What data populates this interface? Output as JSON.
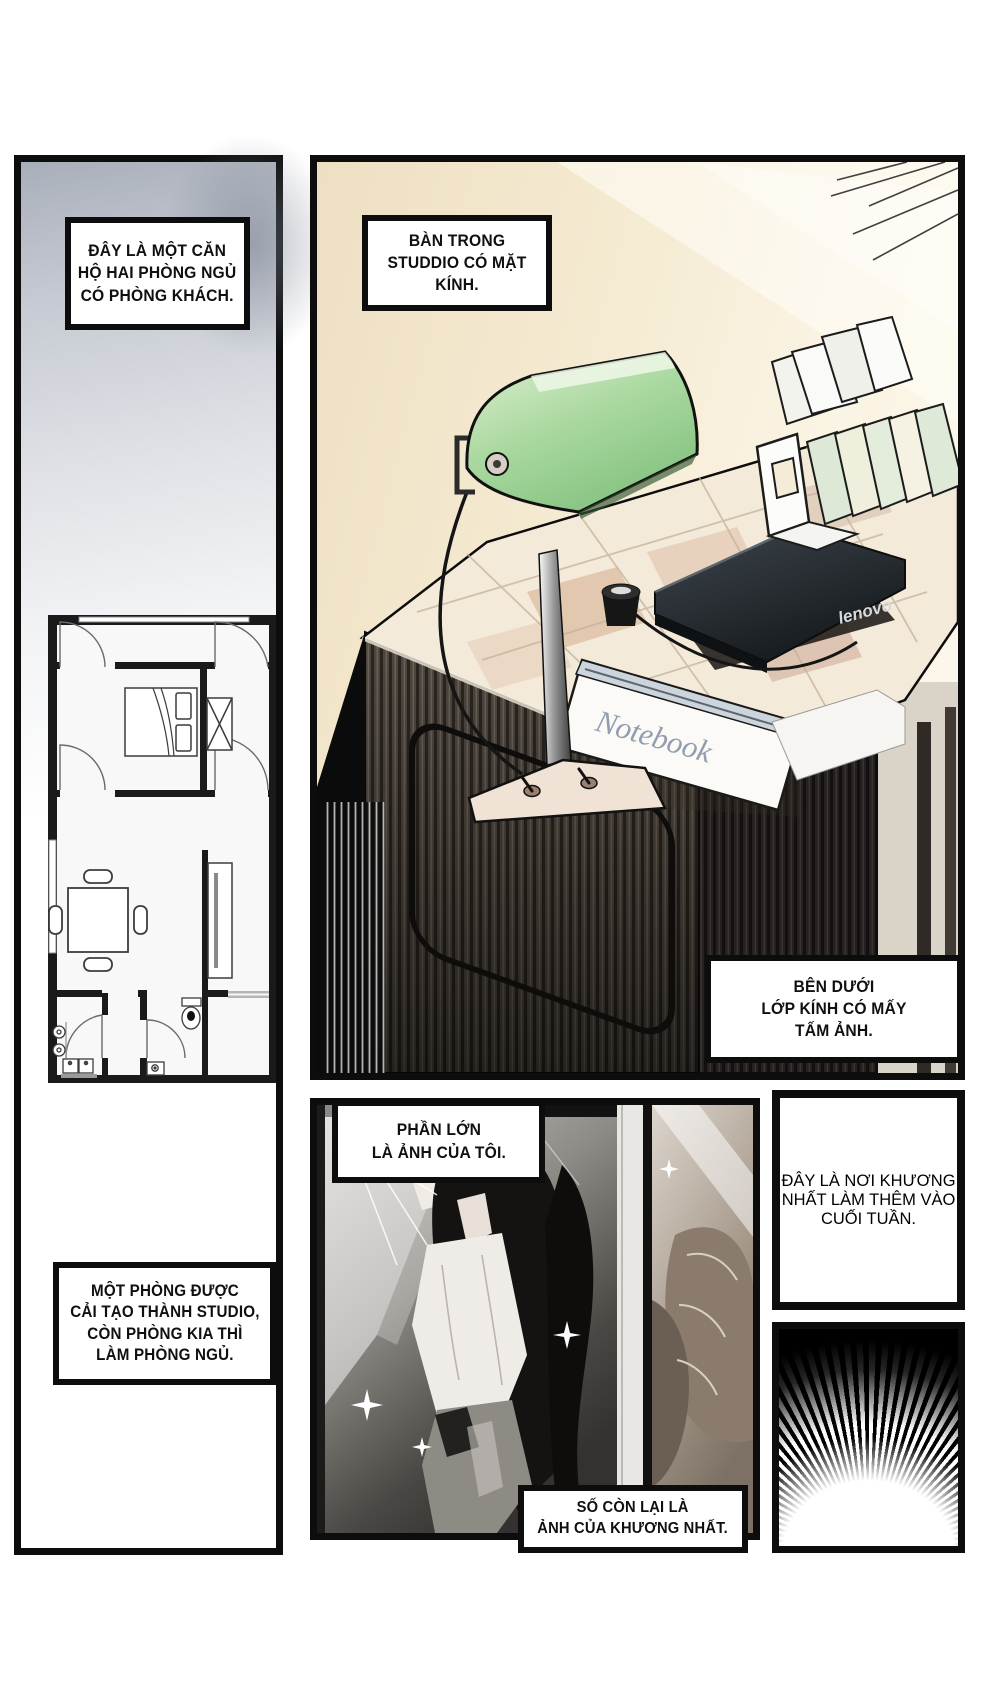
{
  "page": {
    "kind": "comic-page",
    "language": "vi"
  },
  "panels": {
    "apartment": {
      "caption_top": "ĐÂY LÀ MỘT CĂN\nHỘ HAI PHÒNG NGỦ\nCÓ PHÒNG KHÁCH.",
      "caption_bottom": "MỘT PHÒNG ĐƯỢC\nCẢI TẠO THÀNH STUDIO,\nCÒN PHÒNG KIA THÌ\nLÀM PHÒNG NGỦ."
    },
    "studio_desk": {
      "caption_top": "BÀN TRONG\nSTUDDIO CÓ MẶT KÍNH.",
      "caption_bottom": "BÊN DƯỚI\nLỚP KÍNH CÓ MẤY\nTẤM ẢNH.",
      "laptop_logo": "lenovo",
      "notebook_label": "Notebook"
    },
    "photos": {
      "caption_top": "PHẦN LỚN\nLÀ ẢNH CỦA TÔI.",
      "caption_bottom": "SỐ CÒN LẠI LÀ\nẢNH CỦA KHƯƠNG NHẤT."
    },
    "workplace": {
      "caption": "ĐÂY LÀ NƠI KHƯƠNG\nNHẤT LÀM THÊM VÀO\nCUỐI TUẦN."
    }
  },
  "colors": {
    "panel_border": "#0d0d0d",
    "caption_bg": "#ffffff",
    "desk_background": "#f5ebd2",
    "lamp_green": "#9ed395",
    "burst_bg": "#000000"
  }
}
